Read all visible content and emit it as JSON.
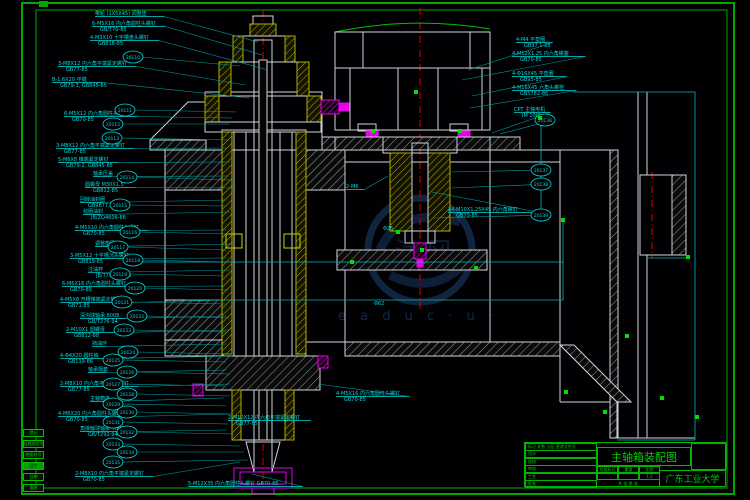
{
  "title_block": {
    "drawing_title": "主轴箱装配图",
    "organization": "广东工业大学",
    "rev_header": [
      "标记",
      "处数",
      "分区",
      "更改文件号",
      "签名",
      "年月日"
    ],
    "sign_rows": [
      "设计",
      "校核",
      "审核",
      "工艺",
      "批准"
    ],
    "stage_headers": [
      "阶段标记",
      "重量",
      "比例"
    ],
    "stage_values": [
      "",
      "",
      "1:2"
    ],
    "sheet_text": "共 张 第 张"
  },
  "margin_stamps": [
    "登记",
    "旧底图总号",
    "底图总号",
    "签字",
    "日期",
    "描图"
  ],
  "watermark": {
    "mark": "沐风图纸",
    "sub": "e a d u c · u ·"
  },
  "colors": {
    "frame": "#00a800",
    "annotation": "#00dcdc",
    "line": "#cfd4d8",
    "hatch": "#b0b000",
    "magenta": "#e800e8",
    "red": "#d80000",
    "green": "#00c000",
    "watermark": "#2a5a9e"
  },
  "annotations": {
    "left": [
      {
        "x": 95,
        "y": 10,
        "l": [
          "带轮 (1X5X45) 调整垫"
        ],
        "t": [
          258,
          42
        ]
      },
      {
        "x": 92,
        "y": 20,
        "l": [
          "6-M5X16 内六角圆柱头螺钉",
          "GB/T70-85"
        ],
        "t": [
          262,
          55
        ]
      },
      {
        "x": 90,
        "y": 34,
        "l": [
          "4-M3X10 十字槽盘头螺钉",
          "GB818-85"
        ],
        "t": [
          268,
          70
        ]
      },
      {
        "x": 58,
        "y": 60,
        "l": [
          "3-M8X12 内六角平端紧定螺钉",
          "GB77-85"
        ],
        "t": [
          245,
          85
        ]
      },
      {
        "x": 52,
        "y": 76,
        "l": [
          "B-1.6X20 平键",
          "GB79-3, GB845-85"
        ],
        "t": [
          250,
          98
        ]
      },
      {
        "x": 64,
        "y": 110,
        "l": [
          "6-M5X12 内六角圆柱头螺钉",
          "GB70-85"
        ],
        "t": [
          232,
          118
        ]
      },
      {
        "x": 56,
        "y": 142,
        "l": [
          "3-M8X12 内六角平端紧定螺钉",
          "GB77-85"
        ],
        "t": [
          226,
          148
        ]
      },
      {
        "x": 58,
        "y": 156,
        "l": [
          "5-M6X8 锥端紧定螺钉",
          "GB79-2, GB845-85"
        ],
        "t": [
          230,
          162
        ]
      },
      {
        "x": 93,
        "y": 170,
        "l": [
          "轴承压盖"
        ],
        "t": [
          228,
          176
        ]
      },
      {
        "x": 85,
        "y": 181,
        "l": [
          "圆螺母 M30X1.5",
          "GB812-85"
        ],
        "t": [
          234,
          188
        ]
      },
      {
        "x": 80,
        "y": 196,
        "l": [
          "回转油封圈",
          "GB9877.1-88"
        ],
        "t": [
          226,
          200
        ]
      },
      {
        "x": 83,
        "y": 208,
        "l": [
          "毡圈油封",
          "JB/ZQ4606-86"
        ],
        "t": [
          230,
          212
        ]
      },
      {
        "x": 75,
        "y": 224,
        "l": [
          "4-M5X10 内六角圆柱头螺钉",
          "GB70-85"
        ],
        "t": [
          226,
          230
        ]
      },
      {
        "x": 95,
        "y": 240,
        "l": [
          "调整垫圈"
        ],
        "t": [
          232,
          244
        ]
      },
      {
        "x": 70,
        "y": 252,
        "l": [
          "3-M5X12 十字槽沉头螺钉",
          "GB819-85"
        ],
        "t": [
          226,
          258
        ]
      },
      {
        "x": 88,
        "y": 266,
        "l": [
          "注油杯",
          "JB/T7940.1-95"
        ],
        "t": [
          230,
          270
        ]
      },
      {
        "x": 62,
        "y": 280,
        "l": [
          "6-M6X16 内六角圆柱头螺钉",
          "GB70-85"
        ],
        "t": [
          224,
          286
        ]
      },
      {
        "x": 60,
        "y": 296,
        "l": [
          "4-M5X8 开槽锥端紧定螺钉",
          "GB71-85"
        ],
        "t": [
          228,
          300
        ]
      },
      {
        "x": 80,
        "y": 312,
        "l": [
          "深沟球轴承 6008",
          "GB/T276-94"
        ],
        "t": [
          226,
          316
        ]
      },
      {
        "x": 66,
        "y": 326,
        "l": [
          "2-M10X1 圆螺母",
          "GB812-88"
        ],
        "t": [
          230,
          330
        ]
      },
      {
        "x": 92,
        "y": 340,
        "l": [
          "挡油环"
        ],
        "t": [
          226,
          344
        ]
      },
      {
        "x": 60,
        "y": 352,
        "l": [
          "4-Φ4X20 圆柱销",
          "GB119-86"
        ],
        "t": [
          232,
          356
        ]
      },
      {
        "x": 88,
        "y": 366,
        "l": [
          "轴承隔套"
        ],
        "t": [
          226,
          370
        ]
      },
      {
        "x": 60,
        "y": 380,
        "l": [
          "2-M8X10 内六角平端紧定螺钉",
          "GB77-85"
        ],
        "t": [
          230,
          384
        ]
      },
      {
        "x": 90,
        "y": 395,
        "l": [
          "主轴箱体"
        ],
        "t": [
          224,
          398
        ]
      },
      {
        "x": 58,
        "y": 410,
        "l": [
          "4-M6X20 内六角圆柱头螺钉",
          "GB70-85"
        ],
        "t": [
          230,
          414
        ]
      },
      {
        "x": 80,
        "y": 425,
        "l": [
          "角接触球轴承 7008C",
          "GB/T292-94"
        ],
        "t": [
          226,
          430
        ]
      },
      {
        "x": 75,
        "y": 470,
        "l": [
          "2-M8X10 内六角平端紧定螺钉",
          "GB70-85"
        ],
        "t": [
          240,
          462
        ]
      }
    ],
    "right": [
      {
        "x": 516,
        "y": 36,
        "l": [
          "4-M4 平垫圈",
          "GB97.1-85"
        ],
        "t": [
          468,
          70
        ]
      },
      {
        "x": 512,
        "y": 50,
        "l": [
          "4-M12X1.25 内六角螺塞",
          "GB70-85"
        ],
        "t": [
          462,
          80
        ]
      },
      {
        "x": 512,
        "y": 70,
        "l": [
          "4-Φ16X45 平垫圈",
          "GB95-85"
        ],
        "t": [
          472,
          96
        ]
      },
      {
        "x": 512,
        "y": 84,
        "l": [
          "4-M16X45 六角头螺栓",
          "GB5782-86"
        ],
        "t": [
          470,
          108
        ]
      },
      {
        "x": 514,
        "y": 106,
        "l": [
          "CPT 主轴电机",
          "IM 100L"
        ],
        "t": [
          492,
          133
        ]
      },
      {
        "x": 448,
        "y": 206,
        "l": [
          "24-M10X1.25X45 内六角螺钉",
          "GB70-85"
        ],
        "t": [
          432,
          192
        ]
      },
      {
        "x": 346,
        "y": 183,
        "l": [
          "2-M6"
        ],
        "t": [
          388,
          176
        ]
      }
    ],
    "bottom": [
      {
        "x": 228,
        "y": 414,
        "l": [
          "2-M10X12 内六角平端紧定螺钉",
          "GB77-85"
        ],
        "t": [
          290,
          420
        ]
      },
      {
        "x": 336,
        "y": 390,
        "l": [
          "4-M5X16 内六角圆柱头螺钉",
          "GB70-85"
        ],
        "t": [
          318,
          384
        ]
      },
      {
        "x": 188,
        "y": 480,
        "l": [
          "5-M12X35 内六角圆柱头螺钉 GB70-85"
        ],
        "t": [
          252,
          474
        ]
      }
    ]
  },
  "balloons": [
    {
      "id": "20110",
      "x": 133,
      "y": 57,
      "t": [
        240,
        66
      ]
    },
    {
      "id": "20111",
      "x": 125,
      "y": 110,
      "t": [
        236,
        112
      ]
    },
    {
      "id": "20112",
      "x": 113,
      "y": 124,
      "t": [
        230,
        124
      ]
    },
    {
      "id": "20113",
      "x": 112,
      "y": 138,
      "t": [
        228,
        140
      ]
    },
    {
      "id": "20114",
      "x": 127,
      "y": 177,
      "t": [
        230,
        180
      ]
    },
    {
      "id": "20115",
      "x": 120,
      "y": 205,
      "t": [
        226,
        206
      ]
    },
    {
      "id": "20116",
      "x": 130,
      "y": 232,
      "t": [
        228,
        234
      ]
    },
    {
      "id": "20117",
      "x": 118,
      "y": 247,
      "t": [
        226,
        250
      ]
    },
    {
      "id": "20118",
      "x": 133,
      "y": 260,
      "t": [
        230,
        262
      ]
    },
    {
      "id": "20119",
      "x": 120,
      "y": 274,
      "t": [
        224,
        276
      ]
    },
    {
      "id": "20120",
      "x": 135,
      "y": 288,
      "t": [
        228,
        290
      ]
    },
    {
      "id": "20121",
      "x": 122,
      "y": 302,
      "t": [
        226,
        304
      ]
    },
    {
      "id": "20122",
      "x": 137,
      "y": 316,
      "t": [
        230,
        318
      ]
    },
    {
      "id": "20123",
      "x": 124,
      "y": 330,
      "t": [
        226,
        332
      ]
    },
    {
      "id": "20124",
      "x": 128,
      "y": 352,
      "t": [
        232,
        354
      ]
    },
    {
      "id": "20125",
      "x": 113,
      "y": 360,
      "t": [
        226,
        362
      ]
    },
    {
      "id": "20126",
      "x": 127,
      "y": 372,
      "t": [
        230,
        374
      ]
    },
    {
      "id": "20127",
      "x": 113,
      "y": 384,
      "t": [
        224,
        386
      ]
    },
    {
      "id": "20128",
      "x": 127,
      "y": 394,
      "t": [
        230,
        396
      ]
    },
    {
      "id": "20129",
      "x": 113,
      "y": 404,
      "t": [
        226,
        406
      ]
    },
    {
      "id": "20130",
      "x": 127,
      "y": 412,
      "t": [
        232,
        414
      ]
    },
    {
      "id": "20131",
      "x": 113,
      "y": 422,
      "t": [
        228,
        424
      ]
    },
    {
      "id": "20132",
      "x": 127,
      "y": 432,
      "t": [
        234,
        434
      ]
    },
    {
      "id": "20133",
      "x": 113,
      "y": 444,
      "t": [
        240,
        446
      ]
    },
    {
      "id": "20134",
      "x": 127,
      "y": 452,
      "t": [
        244,
        452
      ]
    },
    {
      "id": "20135",
      "x": 113,
      "y": 462,
      "t": [
        248,
        460
      ]
    },
    {
      "id": "20136",
      "x": 545,
      "y": 120,
      "t": [
        500,
        134
      ]
    },
    {
      "id": "20137",
      "x": 541,
      "y": 170,
      "t": [
        452,
        172
      ]
    },
    {
      "id": "20138",
      "x": 541,
      "y": 184,
      "t": [
        452,
        188
      ]
    },
    {
      "id": "20139",
      "x": 541,
      "y": 215,
      "t": [
        434,
        218
      ]
    }
  ],
  "grips": [
    [
      352,
      262
    ],
    [
      398,
      232
    ],
    [
      422,
      250
    ],
    [
      476,
      268
    ],
    [
      540,
      118
    ],
    [
      563,
      220
    ],
    [
      566,
      392
    ],
    [
      605,
      412
    ],
    [
      662,
      398
    ],
    [
      697,
      417
    ],
    [
      627,
      336
    ],
    [
      688,
      257
    ],
    [
      416,
      92
    ],
    [
      373,
      131
    ],
    [
      460,
      131
    ]
  ],
  "dim_texts": [
    {
      "x": 374,
      "y": 305,
      "v": "Φ62"
    },
    {
      "x": 383,
      "y": 230,
      "v": "Φ25"
    }
  ]
}
